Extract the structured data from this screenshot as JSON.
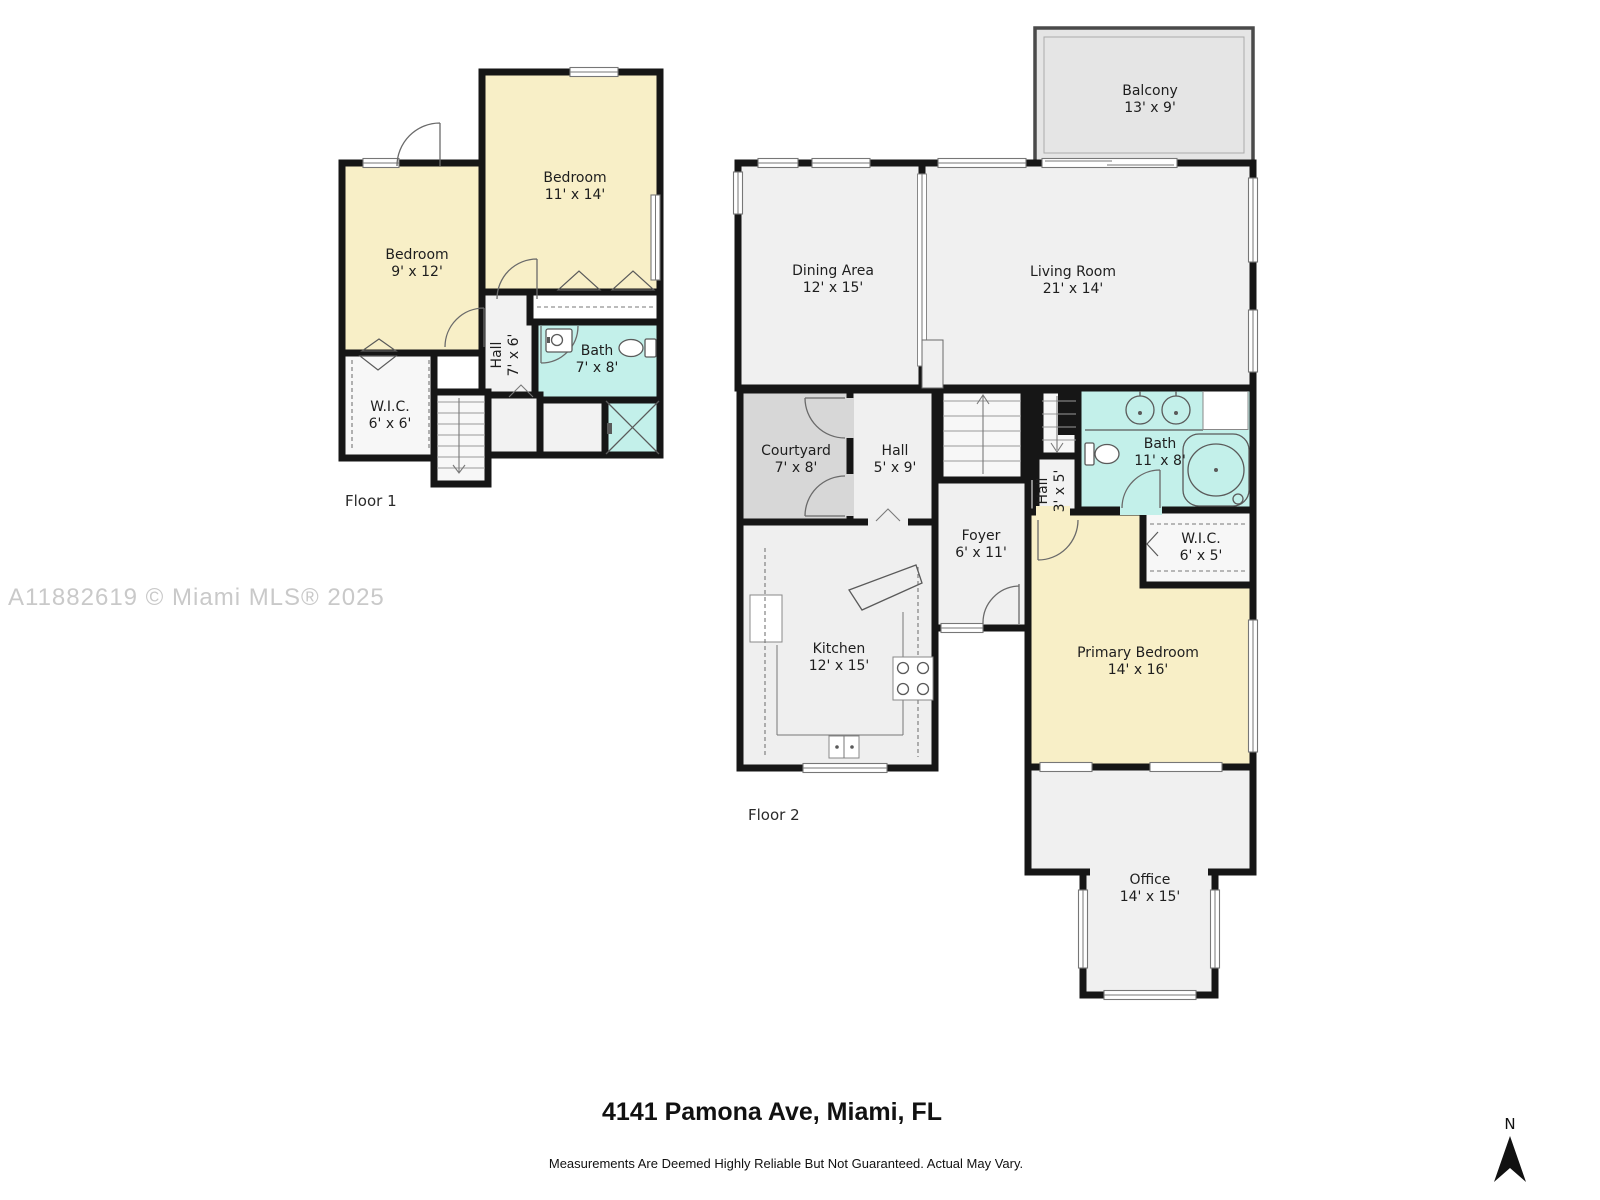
{
  "watermark": "A11882619 © Miami MLS® 2025",
  "footer": {
    "address": "4141 Pamona Ave, Miami, FL",
    "disclaimer": "Measurements Are Deemed Highly Reliable But Not Guaranteed. Actual May Vary."
  },
  "compass": {
    "north_label": "N"
  },
  "floor1": {
    "label": "Floor 1",
    "rooms": {
      "bedroom_small": {
        "name": "Bedroom",
        "dims": "9' x 12'"
      },
      "bedroom_large": {
        "name": "Bedroom",
        "dims": "11' x 14'"
      },
      "hall": {
        "name": "Hall",
        "dims": "7' x 6'"
      },
      "bath": {
        "name": "Bath",
        "dims": "7' x 8'"
      },
      "wic": {
        "name": "W.I.C.",
        "dims": "6' x 6'"
      }
    }
  },
  "floor2": {
    "label": "Floor 2",
    "rooms": {
      "balcony": {
        "name": "Balcony",
        "dims": "13' x 9'"
      },
      "dining": {
        "name": "Dining Area",
        "dims": "12' x 15'"
      },
      "living": {
        "name": "Living Room",
        "dims": "21' x 14'"
      },
      "courtyard": {
        "name": "Courtyard",
        "dims": "7' x 8'"
      },
      "hall": {
        "name": "Hall",
        "dims": "5' x 9'"
      },
      "hall_small": {
        "name": "Hall",
        "dims": "3' x 5'"
      },
      "bath": {
        "name": "Bath",
        "dims": "11' x 8'"
      },
      "wic": {
        "name": "W.I.C.",
        "dims": "6' x 5'"
      },
      "foyer": {
        "name": "Foyer",
        "dims": "6' x 11'"
      },
      "kitchen": {
        "name": "Kitchen",
        "dims": "12' x 15'"
      },
      "primary_bedroom": {
        "name": "Primary Bedroom",
        "dims": "14' x 16'"
      },
      "office": {
        "name": "Office",
        "dims": "14' x 15'"
      }
    }
  },
  "colors": {
    "bedroom_fill": "#F8EFC7",
    "bath_fill": "#C3F0EA",
    "courtyard_fill": "#D7D7D7",
    "room_fill": "#F0F0F0",
    "balcony_fill": "#E5E5E5",
    "wall": "#161616",
    "watermark_gray": "#C9C9C9"
  }
}
